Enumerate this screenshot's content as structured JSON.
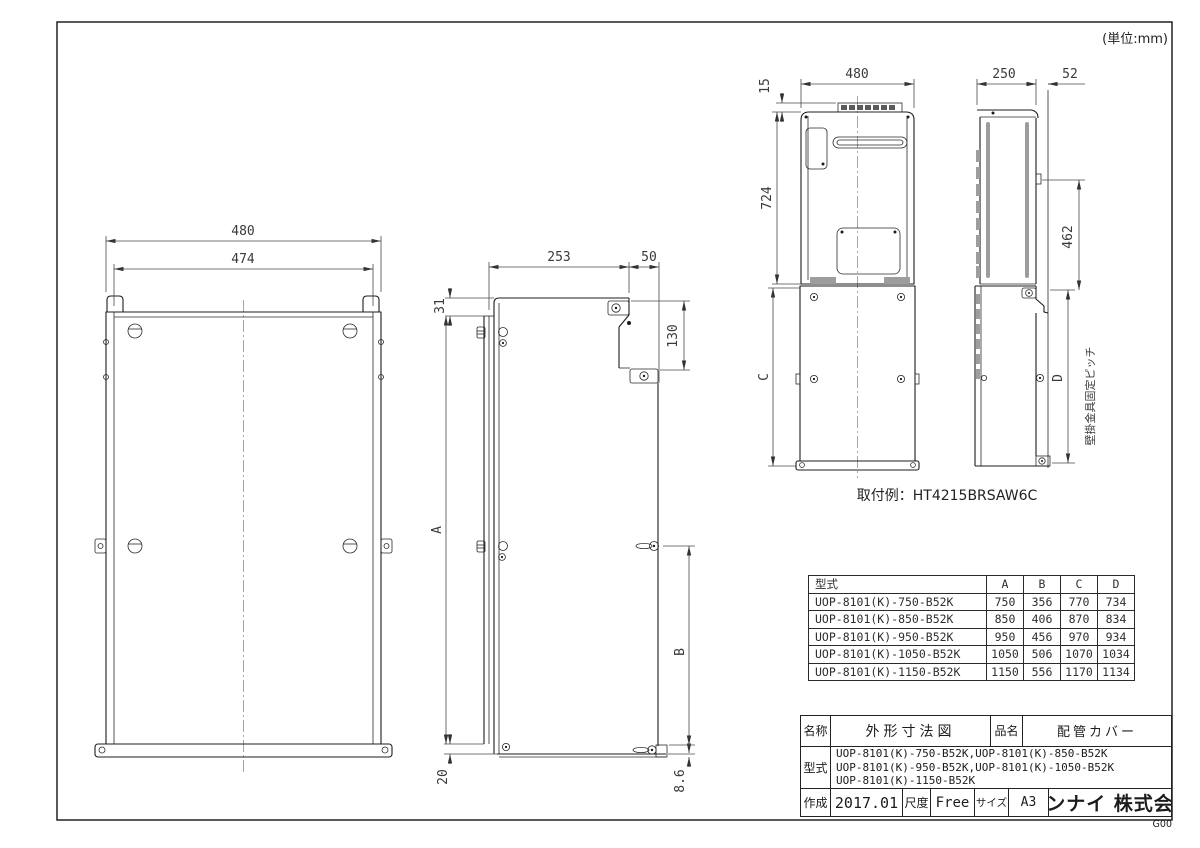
{
  "page": {
    "unit_note": "(単位:mm)",
    "sheet_code": "G00"
  },
  "views": {
    "cover_front": {
      "dim_width_outer": "480",
      "dim_width_inner": "474"
    },
    "cover_side": {
      "dim_depth": "253",
      "dim_flange": "50",
      "dim_top_inset": "31",
      "dim_bracket_height": "130",
      "dim_height_label": "A",
      "dim_fix_pitch_label": "B",
      "dim_bottom_inset": "20",
      "dim_foot": "8.6"
    },
    "installed_front": {
      "dim_top_clearance": "15",
      "dim_width": "480",
      "dim_heater_height": "724",
      "dim_cover_height_label": "C"
    },
    "installed_side": {
      "dim_depth": "250",
      "dim_wall_offset": "52",
      "dim_bracket_pitch": "462",
      "dim_cover_pitch_label": "D",
      "wall_pitch_note": "壁掛金具固定ピッチ"
    },
    "install_example": "取付例：HT4215BRSAW6C"
  },
  "spec_table": {
    "headers": [
      "型式",
      "A",
      "B",
      "C",
      "D"
    ],
    "rows": [
      {
        "model": "UOP-8101(K)-750-B52K",
        "a": "750",
        "b": "356",
        "c": "770",
        "d": "734"
      },
      {
        "model": "UOP-8101(K)-850-B52K",
        "a": "850",
        "b": "406",
        "c": "870",
        "d": "834"
      },
      {
        "model": "UOP-8101(K)-950-B52K",
        "a": "950",
        "b": "456",
        "c": "970",
        "d": "934"
      },
      {
        "model": "UOP-8101(K)-1050-B52K",
        "a": "1050",
        "b": "506",
        "c": "1070",
        "d": "1034"
      },
      {
        "model": "UOP-8101(K)-1150-B52K",
        "a": "1150",
        "b": "556",
        "c": "1170",
        "d": "1134"
      }
    ]
  },
  "title_block": {
    "name_label": "名称",
    "name_value": "外形寸法図",
    "product_label": "品名",
    "product_value": "配管カバー",
    "model_label": "型式",
    "model_lines": [
      "UOP-8101(K)-750-B52K,UOP-8101(K)-850-B52K",
      "UOP-8101(K)-950-B52K,UOP-8101(K)-1050-B52K",
      "UOP-8101(K)-1150-B52K"
    ],
    "created_label": "作成",
    "created_value": "2017.01",
    "scale_label": "尺度",
    "scale_value": "Free",
    "size_label": "サイズ",
    "size_value": "A3",
    "company": "リンナイ 株式会社"
  }
}
